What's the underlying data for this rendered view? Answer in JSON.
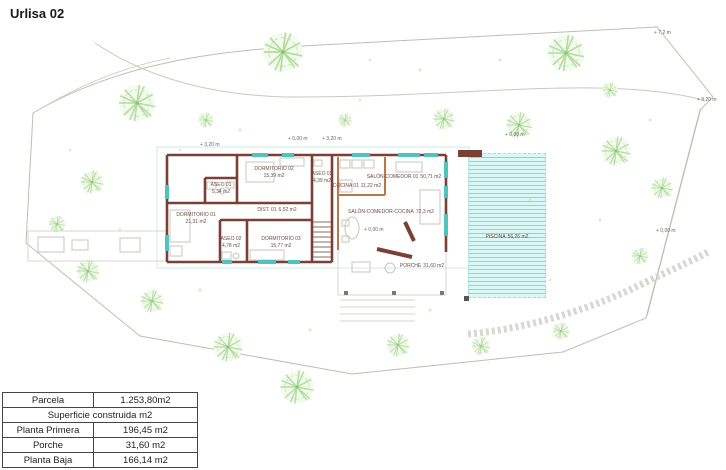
{
  "title": "Urlisa 02",
  "colors": {
    "wall": "#7a4036",
    "wall_secondary": "#b9764a",
    "pool_fill": "#daf8f5",
    "pool_stripe": "#7cdcd5",
    "tree_green": "#b2dc9e",
    "boundary": "#b9c2ad",
    "furniture": "#c9c5bf",
    "label_text": "#6d4c41"
  },
  "plan": {
    "rooms": [
      {
        "name": "DORMITORIO 02",
        "area": "15,39 m2"
      },
      {
        "name": "ASEO 01",
        "area": "5,34 m2"
      },
      {
        "name": "ASEO 03",
        "area": "4,39 m2"
      },
      {
        "name": "COCINA 01",
        "area": "11,22 m2"
      },
      {
        "name": "DORMITORIO 01",
        "area": "21,31 m2"
      },
      {
        "name": "DIST. 01",
        "area": "6,52 m2"
      },
      {
        "name": "ASEO 02",
        "area": "4,78 m2"
      },
      {
        "name": "DORMITORIO 03",
        "area": "15,77 m2"
      },
      {
        "name": "SALÓN-COMEDOR 01",
        "area": "50,71 m2"
      },
      {
        "name": "SALÓN-COMEDOR-COCINA",
        "area": "72,3 m2"
      },
      {
        "name": "PORCHE",
        "area": "31,60 m2"
      },
      {
        "name": "PISCINA",
        "area": "56,26 m2"
      }
    ],
    "annotations": [
      "+ 3,20 m",
      "+ 0,00 m",
      "+ 3,20 m",
      "+ 0,00 m",
      "+ 7,2 m",
      "+ 3,20 m",
      "+ 0,00 m",
      "+ 0,00 m"
    ]
  },
  "table": {
    "section_header": "Superficie construida m2",
    "rows": [
      {
        "label": "Parcela",
        "value": "1.253,80m2"
      },
      {
        "label": "Planta Primera",
        "value": "196,45 m2"
      },
      {
        "label": "Porche",
        "value": "31,60 m2"
      },
      {
        "label": "Planta Baja",
        "value": "166,14 m2"
      }
    ]
  }
}
